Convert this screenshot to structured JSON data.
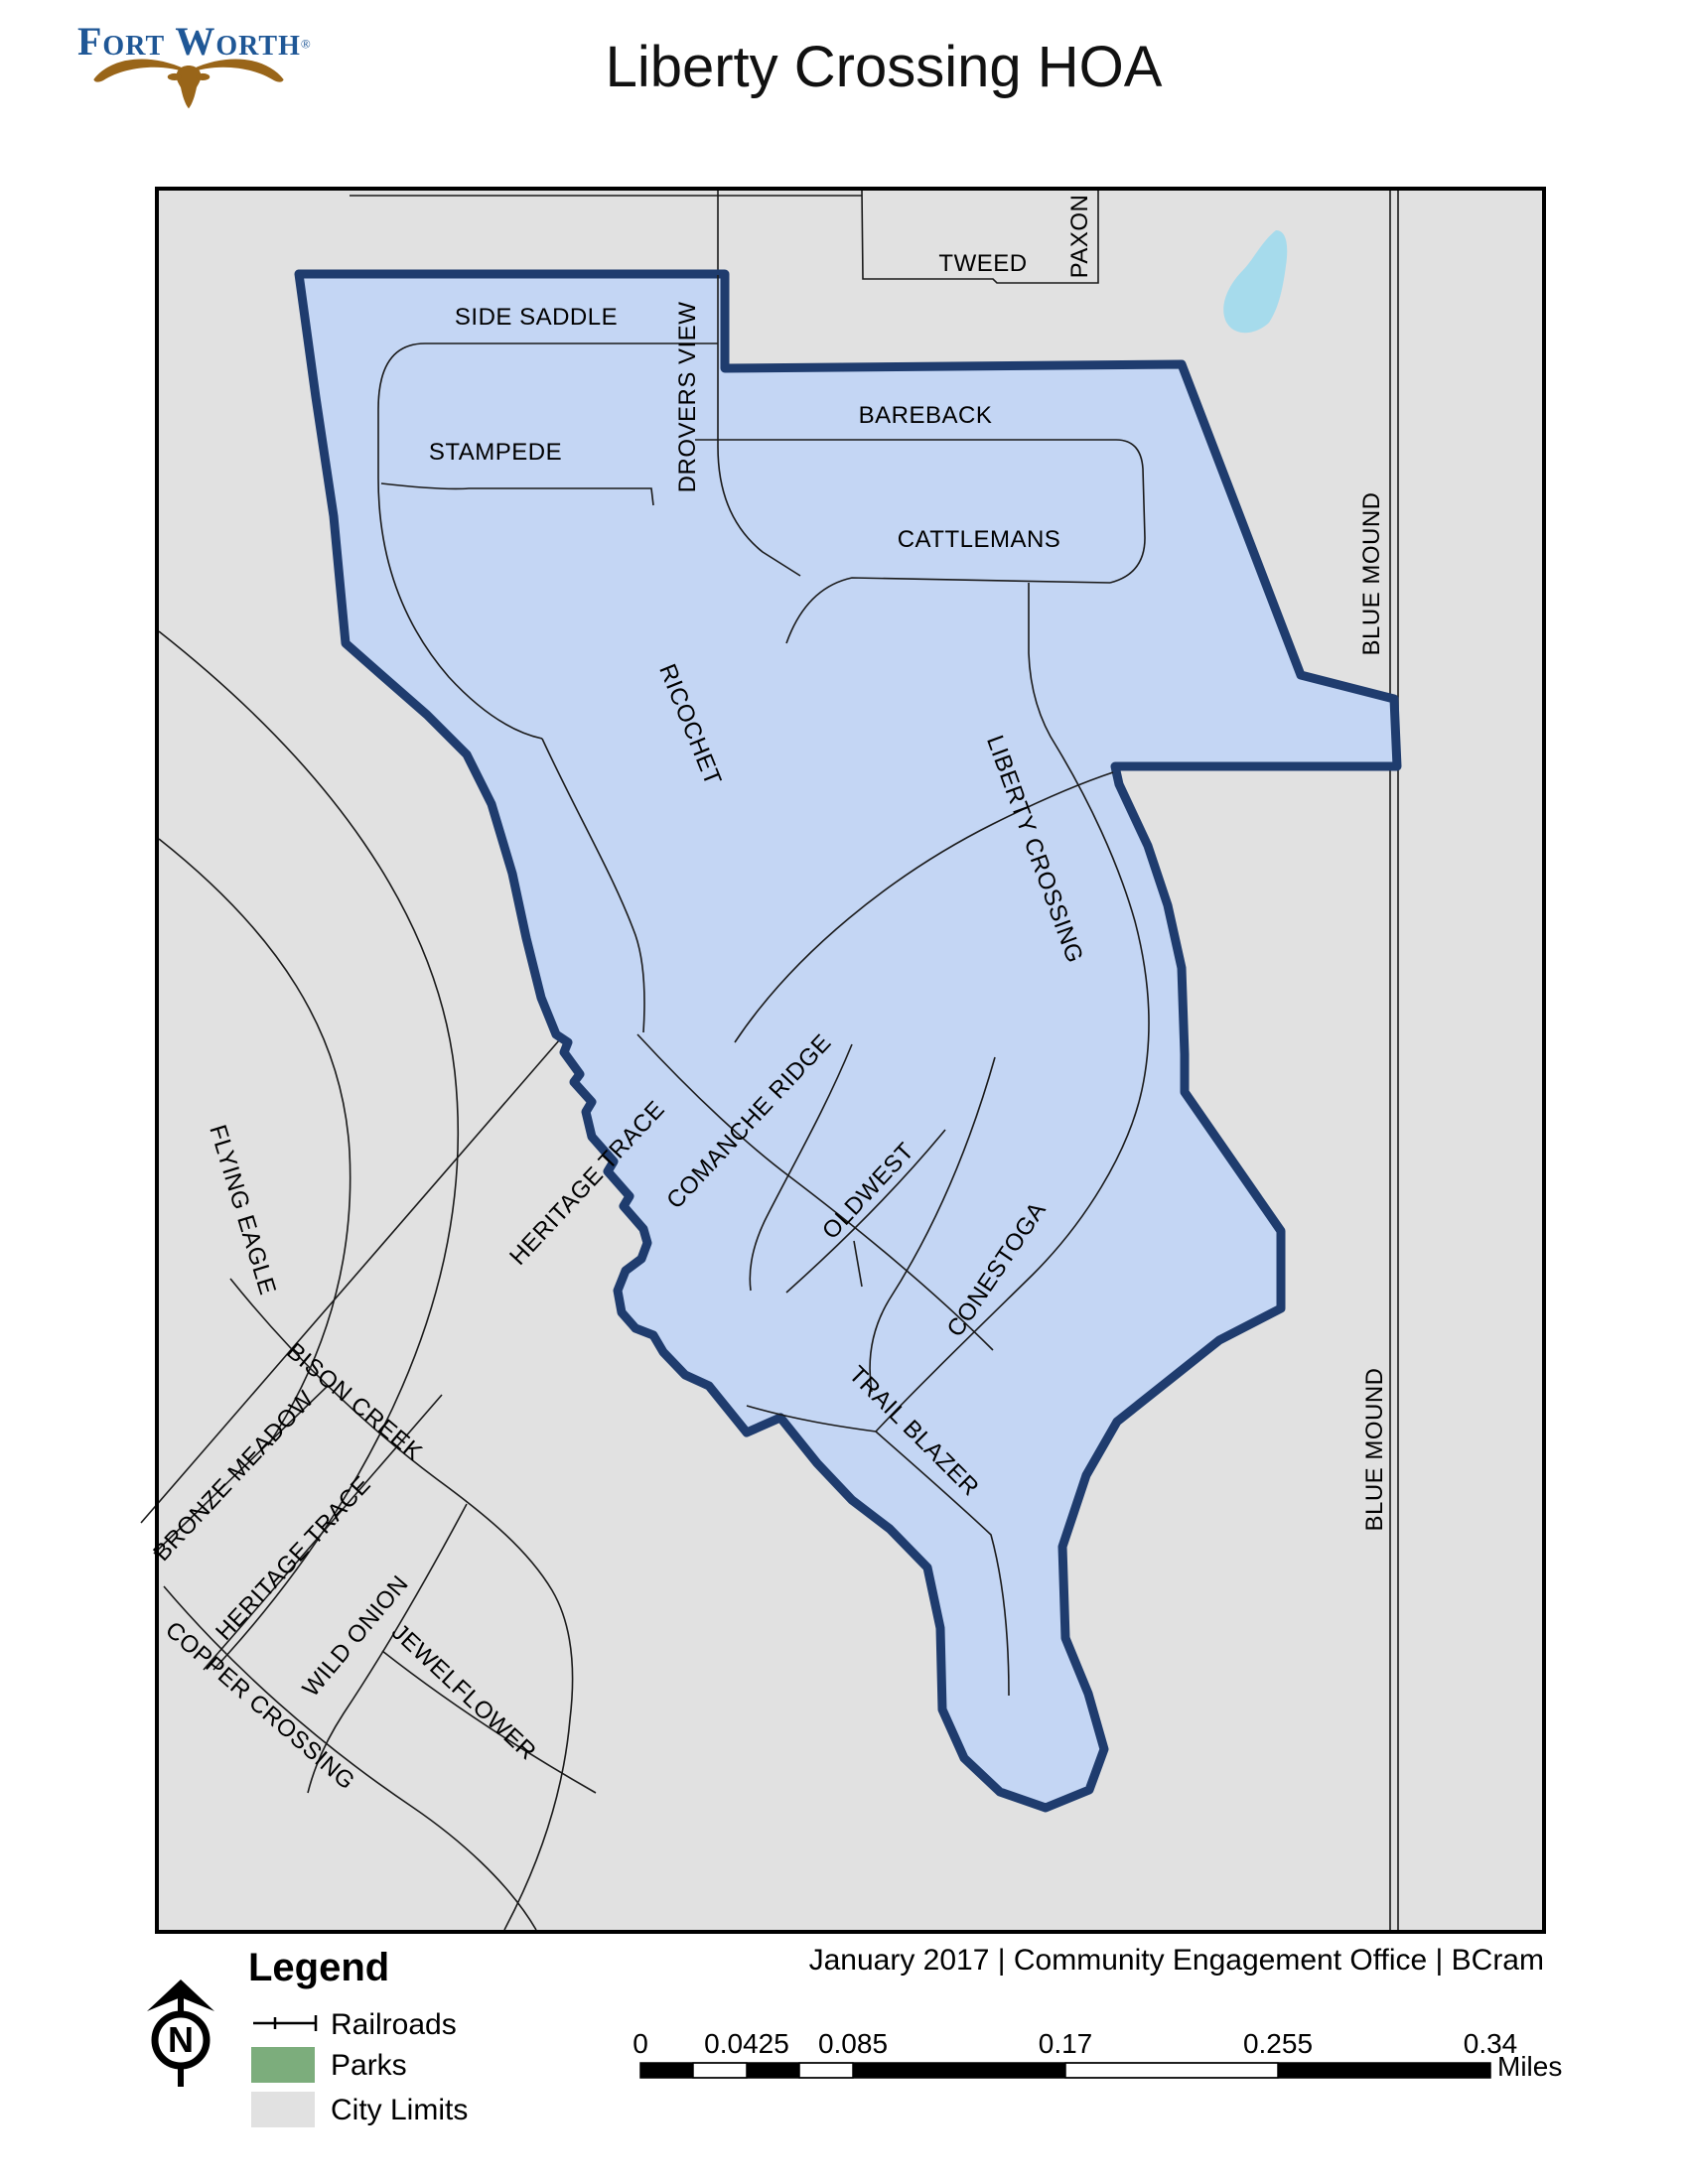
{
  "header": {
    "logo_text": "Fort Worth",
    "logo_registered": "®",
    "title": "Liberty Crossing HOA"
  },
  "map": {
    "street_labels": [
      {
        "id": "tweed",
        "text": "TWEED"
      },
      {
        "id": "paxon",
        "text": "PAXON"
      },
      {
        "id": "side-saddle",
        "text": "SIDE SADDLE"
      },
      {
        "id": "drovers-view",
        "text": "DROVERS VIEW"
      },
      {
        "id": "bareback",
        "text": "BAREBACK"
      },
      {
        "id": "stampede",
        "text": "STAMPEDE"
      },
      {
        "id": "cattlemans",
        "text": "CATTLEMANS"
      },
      {
        "id": "blue-mound-north",
        "text": "BLUE MOUND"
      },
      {
        "id": "ricochet",
        "text": "RICOCHET"
      },
      {
        "id": "liberty-crossing",
        "text": "LIBERTY CROSSING"
      },
      {
        "id": "heritage-trace-north",
        "text": "HERITAGE TRACE"
      },
      {
        "id": "comanche-ridge",
        "text": "COMANCHE RIDGE"
      },
      {
        "id": "oldwest",
        "text": "OLDWEST"
      },
      {
        "id": "conestoga",
        "text": "CONESTOGA"
      },
      {
        "id": "flying-eagle",
        "text": "FLYING EAGLE"
      },
      {
        "id": "trail-blazer",
        "text": "TRAIL BLAZER"
      },
      {
        "id": "bison-creek",
        "text": "BISON CREEK"
      },
      {
        "id": "bronze-meadow",
        "text": "BRONZE MEADOW"
      },
      {
        "id": "heritage-trace-south",
        "text": "HERITAGE TRACE"
      },
      {
        "id": "wild-onion",
        "text": "WILD ONION"
      },
      {
        "id": "jewelflower",
        "text": "JEWELFLOWER"
      },
      {
        "id": "copper-crossing",
        "text": "COPPER CROSSING"
      },
      {
        "id": "blue-mound-south",
        "text": "BLUE MOUND"
      }
    ]
  },
  "legend": {
    "title": "Legend",
    "items": [
      {
        "label": "Railroads",
        "symbol": "railroad-line"
      },
      {
        "label": "Parks",
        "symbol": "green-swatch"
      },
      {
        "label": "City Limits",
        "symbol": "gray-swatch"
      }
    ]
  },
  "north_arrow": {
    "letter": "N"
  },
  "scale_bar": {
    "ticks": [
      "0",
      "0.0425",
      "0.085",
      "0.17",
      "0.255",
      "0.34"
    ],
    "unit": "Miles"
  },
  "credits": "January 2017 | Community Engagement Office | BCram",
  "colors": {
    "hoa_fill": "#C4D6F4",
    "hoa_border": "#1F3C6E",
    "city_limits": "#E1E1E1",
    "water": "#A6DBEC",
    "parks": "#7CAD7C",
    "logo_blue": "#1F5796",
    "logo_brown": "#996519"
  }
}
